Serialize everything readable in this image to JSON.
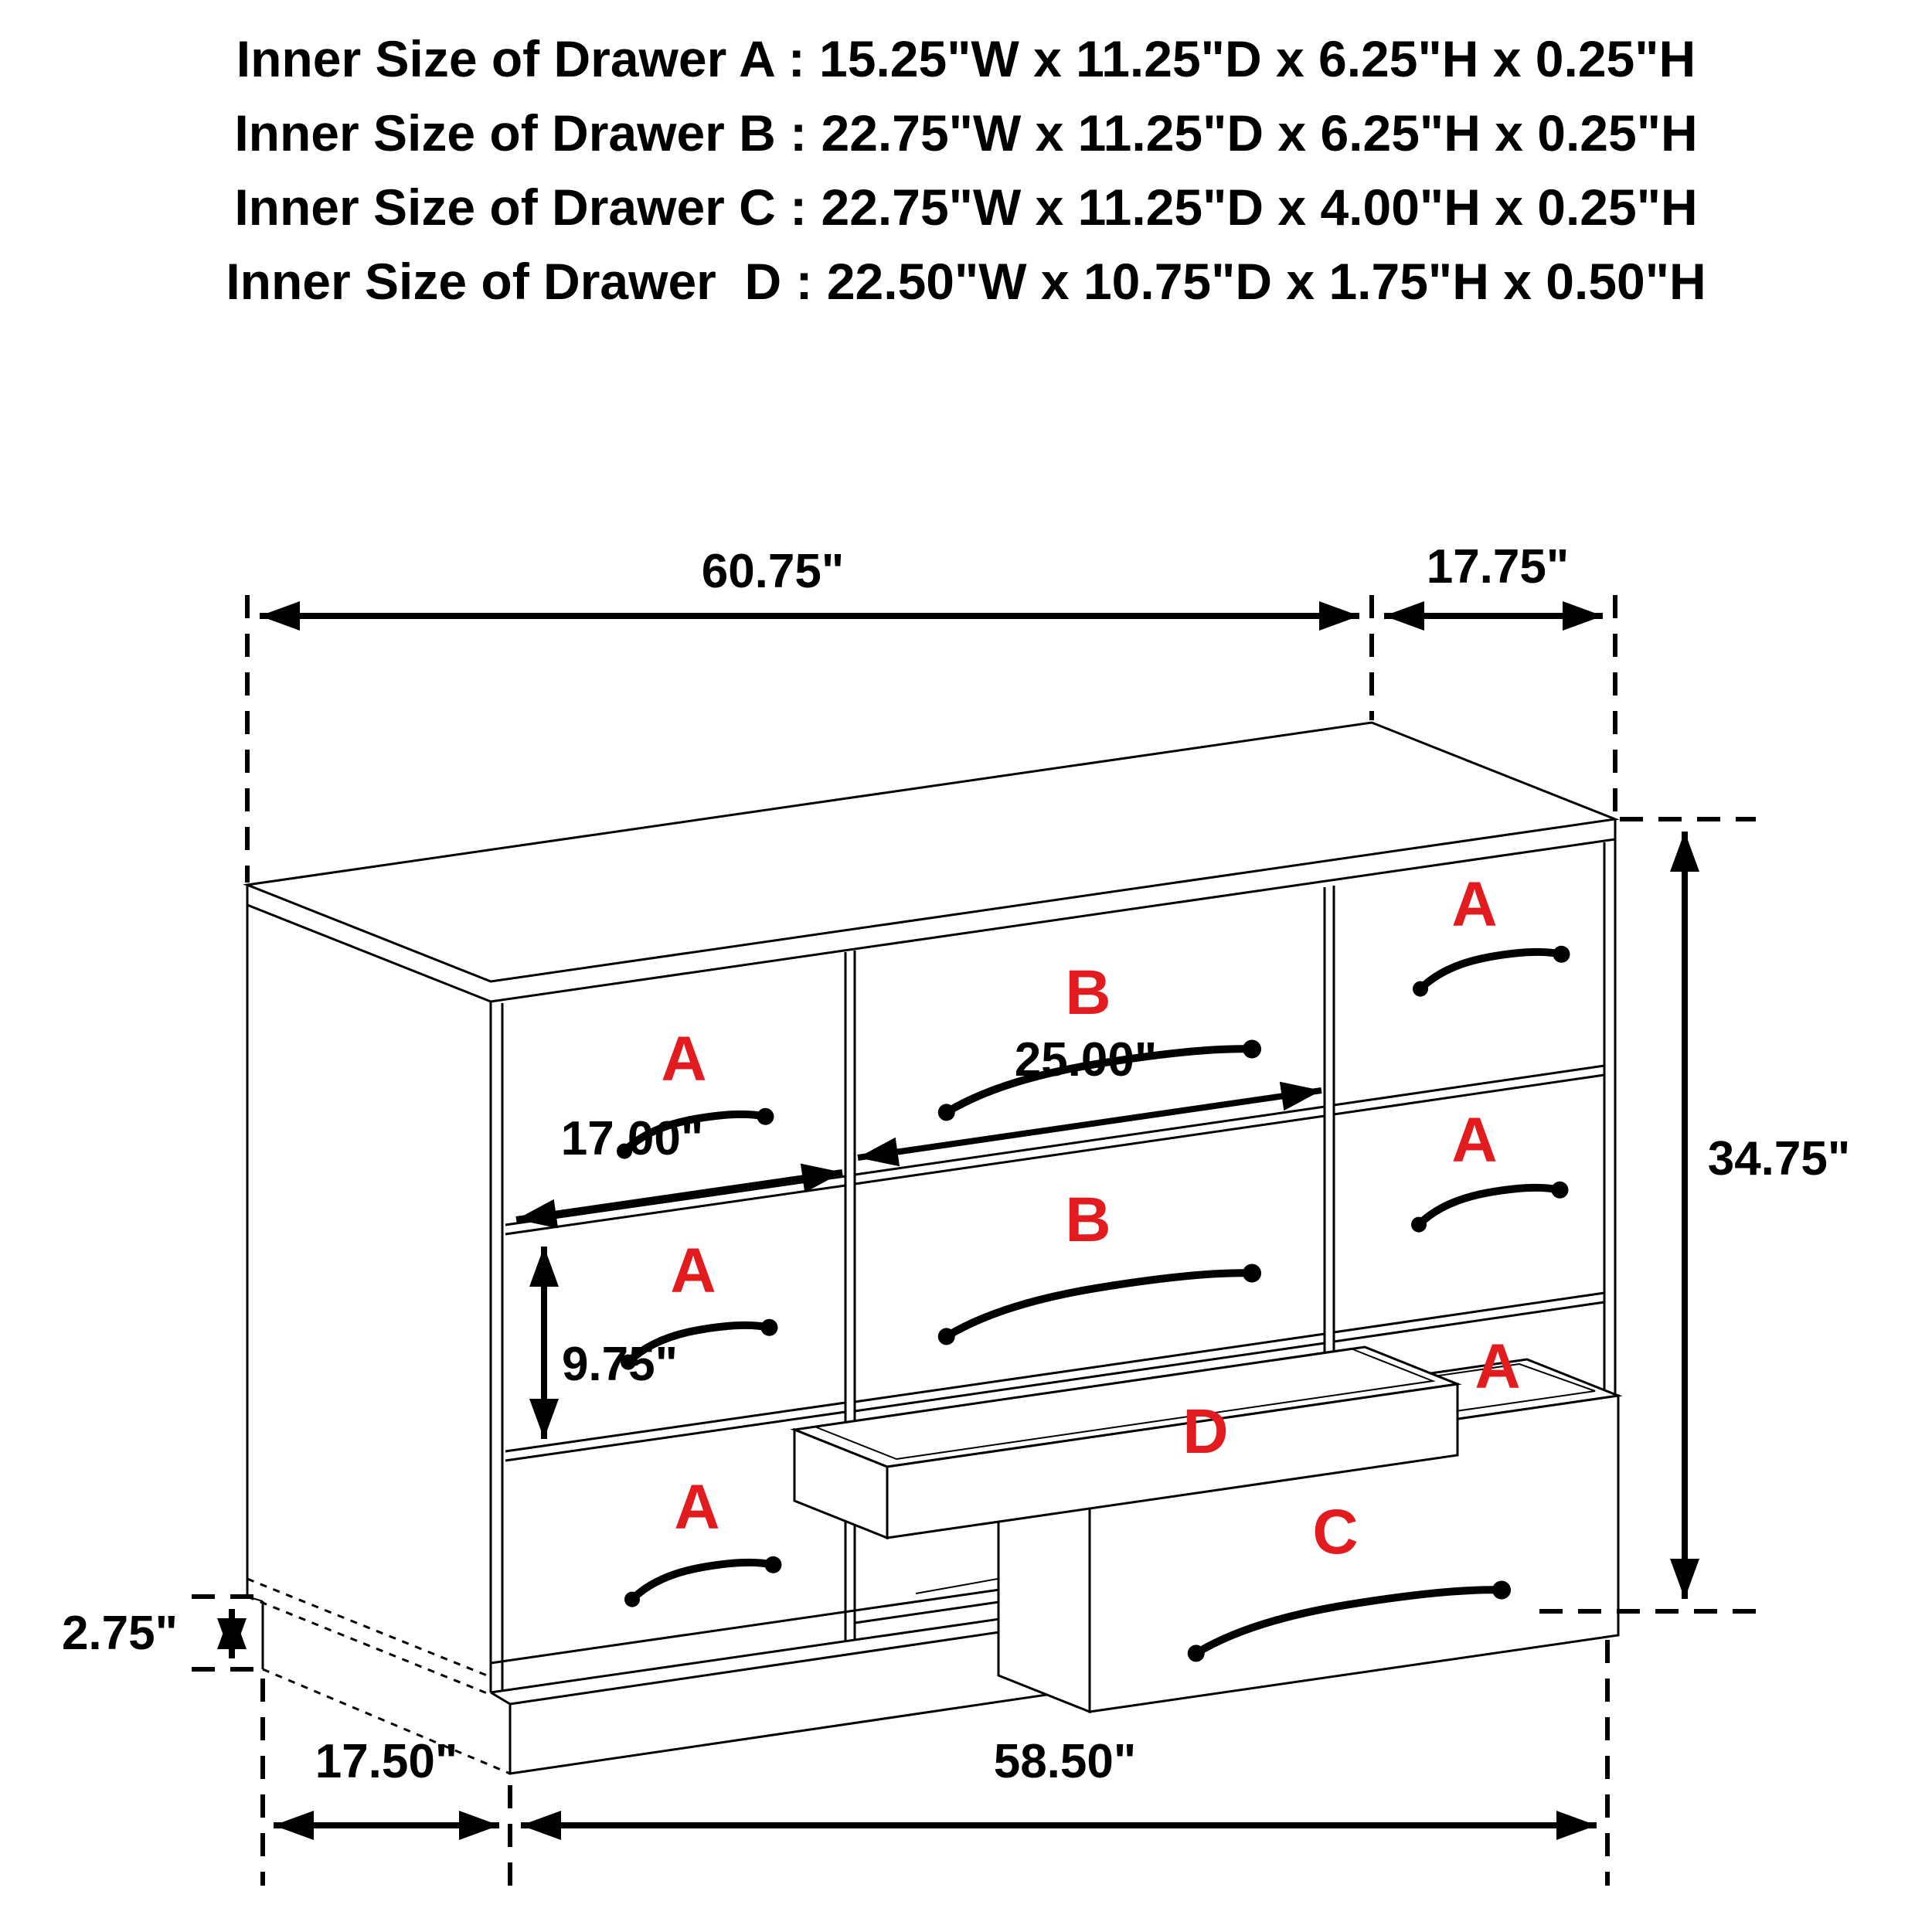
{
  "title_block": {
    "lines": [
      "Inner Size of Drawer A : 15.25\"W x 11.25\"D x 6.25\"H x 0.25\"H",
      "Inner Size of Drawer B : 22.75\"W x 11.25\"D x 6.25\"H x 0.25\"H",
      "Inner Size of Drawer C : 22.75\"W x 11.25\"D x 4.00\"H x 0.25\"H",
      "Inner Size of Drawer  D : 22.50\"W x 10.75\"D x 1.75\"H x 0.50\"H"
    ]
  },
  "diagram": {
    "dimension_labels": {
      "top_width": "60.75\"",
      "top_depth": "17.75\"",
      "overall_height": "34.75\"",
      "drawer_a_width": "17.00\"",
      "drawer_b_width": "25.00\"",
      "drawer_a_front_height": "9.75\"",
      "base_height": "2.75\"",
      "floor_depth": "17.50\"",
      "floor_width": "58.50\""
    },
    "drawer_letters": {
      "a": "A",
      "b": "B",
      "c": "C",
      "d": "D"
    },
    "colors": {
      "line_color": "#000000",
      "drawer_label_color": "#e21b1e",
      "background": "#ffffff"
    }
  }
}
